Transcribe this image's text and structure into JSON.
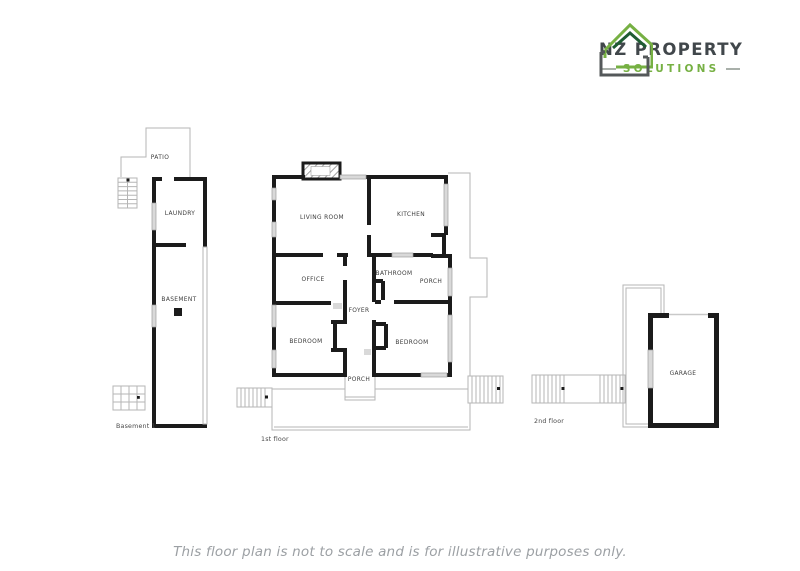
{
  "logo": {
    "icon": "house-logo-icon",
    "title": "NZ PROPERTY",
    "subtitle": "SOLUTIONS"
  },
  "plans": {
    "basement": {
      "caption": "Basement 1",
      "rooms": {
        "patio": "PATIO",
        "laundry": "LAUNDRY",
        "basement": "BASEMENT"
      }
    },
    "first_floor": {
      "caption": "1st floor",
      "rooms": {
        "living_room": "LIVING ROOM",
        "kitchen": "KITCHEN",
        "office": "OFFICE",
        "bathroom": "BATHROOM",
        "porch_right": "PORCH",
        "foyer": "FOYER",
        "bedroom_left": "BEDROOM",
        "bedroom_right": "BEDROOM",
        "porch_bottom": "PORCH"
      }
    },
    "second_floor": {
      "caption": "2nd floor",
      "rooms": {
        "garage": "GARAGE"
      }
    }
  },
  "footer": {
    "disclaimer": "This floor plan is not to scale and is for illustrative purposes only."
  },
  "colors": {
    "brand_green": "#76b043",
    "brand_dark_green": "#1e5c33",
    "brand_charcoal": "#41474b",
    "wall_black": "#1b1b1b",
    "window_gray": "#d9d9d9",
    "outline_gray": "#b5b5b5",
    "label_gray": "#3e3e3e",
    "disclaimer_gray": "#9ca0a4"
  }
}
